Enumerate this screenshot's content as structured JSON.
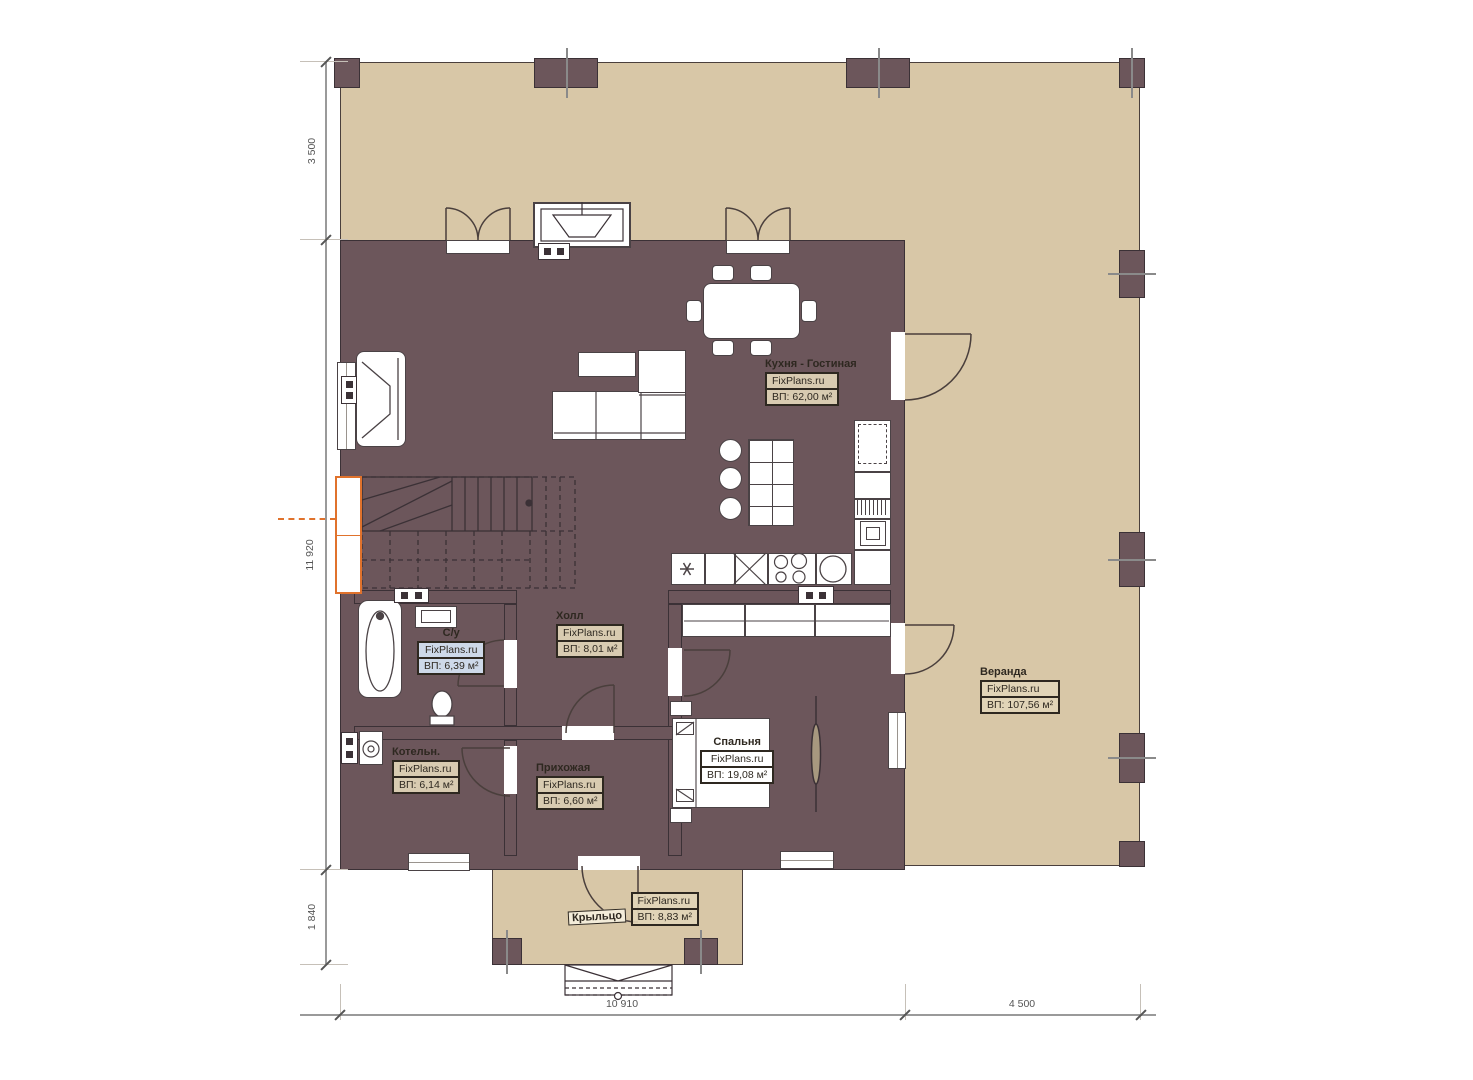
{
  "brand": "FixPlans.ru",
  "rooms": {
    "kitchen_living": {
      "name": "Кухня - Гостиная",
      "brand": "FixPlans.ru",
      "area": "ВП:  62,00 м²"
    },
    "bathroom": {
      "name": "С/у",
      "brand": "FixPlans.ru",
      "area": "ВП: 6,39 м²"
    },
    "hall": {
      "name": "Холл",
      "brand": "FixPlans.ru",
      "area": "ВП: 8,01 м²"
    },
    "boiler": {
      "name": "Котельн.",
      "brand": "FixPlans.ru",
      "area": "ВП: 6,14 м²"
    },
    "entry": {
      "name": "Прихожая",
      "brand": "FixPlans.ru",
      "area": "ВП: 6,60 м²"
    },
    "bedroom": {
      "name": "Спальня",
      "brand": "FixPlans.ru",
      "area": "ВП: 19,08 м²"
    },
    "veranda": {
      "name": "Веранда",
      "brand": "FixPlans.ru",
      "area": "ВП: 107,56 м²"
    },
    "porch": {
      "name": "Крыльцо",
      "brand": "FixPlans.ru",
      "area": "ВП: 8,83 м²"
    }
  },
  "dimensions": {
    "left_top": "3 500",
    "left_middle": "11 920",
    "left_bottom": "1 840",
    "bottom_house": "10 910",
    "bottom_veranda": "4 500"
  },
  "colors": {
    "selection_orange": "#e0722c",
    "wall": "#6c565b",
    "veranda_floor": "#d8c7a7",
    "kitchen_tile": "#d5c29e",
    "bathroom_tile": "#abcdec",
    "bedroom_floor": "#8a7157"
  }
}
